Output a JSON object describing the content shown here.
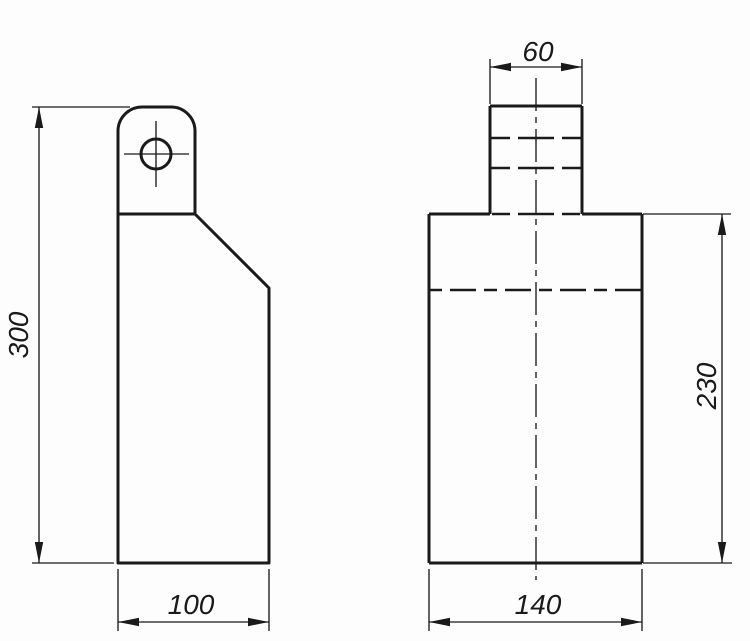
{
  "drawing": {
    "canvas": {
      "width": 750,
      "height": 641,
      "background": "#fdfdfd",
      "ink": "#1a1a1a"
    },
    "line_weights": {
      "outline": 3,
      "hidden": 2.4,
      "thin": 1.35
    },
    "label_font_px": 28,
    "views": {
      "left_view": {
        "name": "side-view",
        "outline_path": "M118 563 L118 131 A24 24 0 0 1 142 107 L171 107 A24 24 0 0 1 195 131 L195 214 L269 288 L269 563 Z",
        "inner_lines": [
          [
            118,
            214,
            195,
            214
          ]
        ],
        "hole": {
          "cx": 156,
          "cy": 154,
          "r": 15,
          "crosshair": [
            [
              124,
              154,
              189,
              154
            ],
            [
              156,
              121,
              156,
              187
            ]
          ]
        }
      },
      "front_view": {
        "name": "front-view",
        "outline_lines": [
          [
            490,
            106,
            582,
            106
          ],
          [
            490,
            106,
            490,
            214
          ],
          [
            582,
            106,
            582,
            214
          ],
          [
            429,
            214,
            490,
            214
          ],
          [
            582,
            214,
            642,
            214
          ],
          [
            429,
            214,
            429,
            563
          ],
          [
            642,
            214,
            642,
            563
          ],
          [
            429,
            563,
            642,
            563
          ]
        ],
        "hidden_lines": [
          {
            "pts": [
              490,
              138,
              582,
              138
            ],
            "dash": "20 8 36 8"
          },
          {
            "pts": [
              490,
              168,
              582,
              168
            ],
            "dash": "20 8 36 8"
          },
          {
            "pts": [
              492,
              214,
              580,
              214
            ],
            "dash": "18 8 36 8"
          },
          {
            "pts": [
              429,
              290,
              642,
              290
            ],
            "dash": "13 8 26 8"
          }
        ],
        "center_lines": [
          {
            "pts": [
              536,
              78,
              536,
              580
            ],
            "dash": "33 6 6 6"
          }
        ]
      }
    },
    "dimensions": [
      {
        "value": "300",
        "orientation": "vertical",
        "dim_line": [
          39,
          107,
          39,
          563
        ],
        "extension_lines": [
          [
            32,
            107,
            130,
            107
          ],
          [
            32,
            563,
            114,
            563
          ]
        ],
        "arrows": [
          {
            "x": 39,
            "y": 107,
            "angle": -90
          },
          {
            "x": 39,
            "y": 563,
            "angle": 90
          }
        ],
        "label": {
          "x": 28,
          "y": 335,
          "rotate": -90
        }
      },
      {
        "value": "100",
        "orientation": "horizontal",
        "dim_line": [
          118,
          622,
          269,
          622
        ],
        "extension_lines": [
          [
            118,
            569,
            118,
            631
          ],
          [
            269,
            569,
            269,
            631
          ]
        ],
        "arrows": [
          {
            "x": 118,
            "y": 622,
            "angle": 180
          },
          {
            "x": 269,
            "y": 622,
            "angle": 0
          }
        ],
        "label": {
          "x": 191,
          "y": 614,
          "rotate": 0
        }
      },
      {
        "value": "60",
        "orientation": "horizontal",
        "dim_line": [
          490,
          67,
          582,
          67
        ],
        "extension_lines": [
          [
            490,
            59,
            490,
            104
          ],
          [
            582,
            59,
            582,
            104
          ]
        ],
        "arrows": [
          {
            "x": 490,
            "y": 67,
            "angle": 180
          },
          {
            "x": 582,
            "y": 67,
            "angle": 0
          }
        ],
        "label": {
          "x": 538,
          "y": 61,
          "rotate": 0
        }
      },
      {
        "value": "230",
        "orientation": "vertical",
        "dim_line": [
          722,
          214,
          722,
          563
        ],
        "extension_lines": [
          [
            643,
            214,
            731,
            214
          ],
          [
            643,
            563,
            732,
            563
          ]
        ],
        "arrows": [
          {
            "x": 722,
            "y": 214,
            "angle": -90
          },
          {
            "x": 722,
            "y": 563,
            "angle": 90
          }
        ],
        "label": {
          "x": 716,
          "y": 386,
          "rotate": -90
        }
      },
      {
        "value": "140",
        "orientation": "horizontal",
        "dim_line": [
          429,
          622,
          642,
          622
        ],
        "extension_lines": [
          [
            429,
            569,
            429,
            631
          ],
          [
            642,
            569,
            642,
            631
          ]
        ],
        "arrows": [
          {
            "x": 429,
            "y": 622,
            "angle": 180
          },
          {
            "x": 642,
            "y": 622,
            "angle": 0
          }
        ],
        "label": {
          "x": 538,
          "y": 614,
          "rotate": 0
        }
      }
    ]
  }
}
